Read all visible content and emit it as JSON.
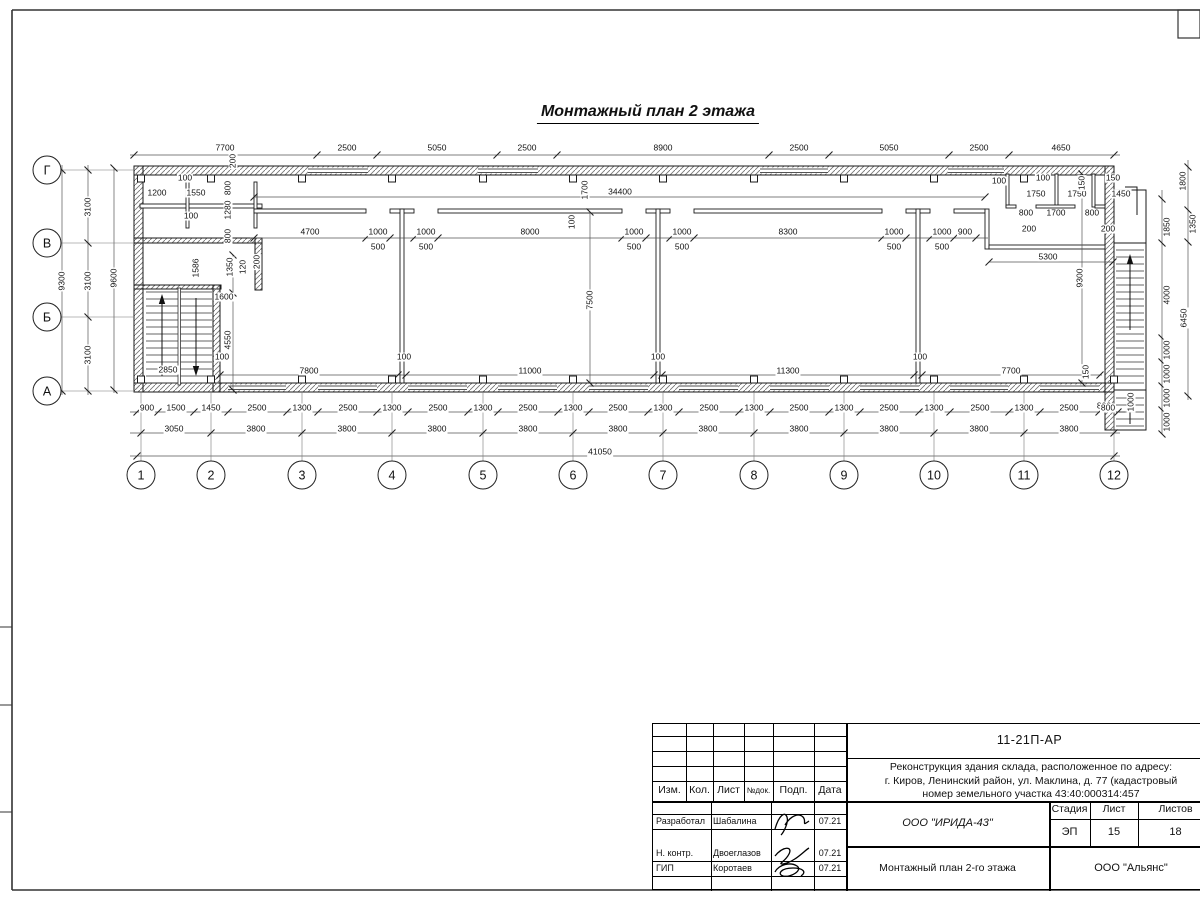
{
  "page": {
    "title_label": "Монтажный план 2 этажа"
  },
  "axes": {
    "cols": [
      {
        "label": "1",
        "x": 141
      },
      {
        "label": "2",
        "x": 211
      },
      {
        "label": "3",
        "x": 302
      },
      {
        "label": "4",
        "x": 392
      },
      {
        "label": "5",
        "x": 483
      },
      {
        "label": "6",
        "x": 573
      },
      {
        "label": "7",
        "x": 663
      },
      {
        "label": "8",
        "x": 754
      },
      {
        "label": "9",
        "x": 844
      },
      {
        "label": "10",
        "x": 934
      },
      {
        "label": "11",
        "x": 1024
      },
      {
        "label": "12",
        "x": 1114
      }
    ],
    "rows": [
      {
        "label": "Г",
        "y": 170
      },
      {
        "label": "В",
        "y": 243
      },
      {
        "label": "Б",
        "y": 317
      },
      {
        "label": "А",
        "y": 391
      }
    ]
  },
  "dims": [
    {
      "x": 225,
      "y": 148,
      "t": "7700"
    },
    {
      "x": 347,
      "y": 148,
      "t": "2500"
    },
    {
      "x": 437,
      "y": 148,
      "t": "5050"
    },
    {
      "x": 527,
      "y": 148,
      "t": "2500"
    },
    {
      "x": 663,
      "y": 148,
      "t": "8900"
    },
    {
      "x": 799,
      "y": 148,
      "t": "2500"
    },
    {
      "x": 889,
      "y": 148,
      "t": "5050"
    },
    {
      "x": 979,
      "y": 148,
      "t": "2500"
    },
    {
      "x": 1061,
      "y": 148,
      "t": "4650"
    },
    {
      "x": 233,
      "y": 161,
      "t": "200",
      "v": 1
    },
    {
      "x": 185,
      "y": 178,
      "t": "100"
    },
    {
      "x": 157,
      "y": 193,
      "t": "1200"
    },
    {
      "x": 196,
      "y": 193,
      "t": "1550"
    },
    {
      "x": 191,
      "y": 216,
      "t": "100"
    },
    {
      "x": 228,
      "y": 188,
      "t": "800",
      "v": 1
    },
    {
      "x": 228,
      "y": 210,
      "t": "1280",
      "v": 1
    },
    {
      "x": 228,
      "y": 236,
      "t": "800",
      "v": 1
    },
    {
      "x": 230,
      "y": 267,
      "t": "1350",
      "v": 1
    },
    {
      "x": 243,
      "y": 267,
      "t": "120",
      "v": 1
    },
    {
      "x": 257,
      "y": 262,
      "t": "200",
      "v": 1
    },
    {
      "x": 196,
      "y": 268,
      "t": "1586",
      "v": 1
    },
    {
      "x": 224,
      "y": 297,
      "t": "1600"
    },
    {
      "x": 228,
      "y": 340,
      "t": "4550",
      "v": 1
    },
    {
      "x": 222,
      "y": 357,
      "t": "100"
    },
    {
      "x": 168,
      "y": 370,
      "t": "2850"
    },
    {
      "x": 88,
      "y": 207,
      "t": "3100",
      "v": 1
    },
    {
      "x": 88,
      "y": 281,
      "t": "3100",
      "v": 1
    },
    {
      "x": 88,
      "y": 355,
      "t": "3100",
      "v": 1
    },
    {
      "x": 62,
      "y": 281,
      "t": "9300",
      "v": 1
    },
    {
      "x": 114,
      "y": 278,
      "t": "9600",
      "v": 1
    },
    {
      "x": 310,
      "y": 232,
      "t": "4700"
    },
    {
      "x": 378,
      "y": 232,
      "t": "1000"
    },
    {
      "x": 378,
      "y": 247,
      "t": "500"
    },
    {
      "x": 426,
      "y": 232,
      "t": "1000"
    },
    {
      "x": 426,
      "y": 247,
      "t": "500"
    },
    {
      "x": 530,
      "y": 232,
      "t": "8000"
    },
    {
      "x": 572,
      "y": 222,
      "t": "100",
      "v": 1
    },
    {
      "x": 634,
      "y": 232,
      "t": "1000"
    },
    {
      "x": 634,
      "y": 247,
      "t": "500"
    },
    {
      "x": 682,
      "y": 232,
      "t": "1000"
    },
    {
      "x": 682,
      "y": 247,
      "t": "500"
    },
    {
      "x": 788,
      "y": 232,
      "t": "8300"
    },
    {
      "x": 894,
      "y": 232,
      "t": "1000"
    },
    {
      "x": 894,
      "y": 247,
      "t": "500"
    },
    {
      "x": 942,
      "y": 232,
      "t": "1000"
    },
    {
      "x": 942,
      "y": 247,
      "t": "500"
    },
    {
      "x": 965,
      "y": 232,
      "t": "900"
    },
    {
      "x": 585,
      "y": 190,
      "t": "1700",
      "v": 1
    },
    {
      "x": 620,
      "y": 192,
      "t": "34400"
    },
    {
      "x": 590,
      "y": 300,
      "t": "7500",
      "v": 1
    },
    {
      "x": 1048,
      "y": 257,
      "t": "5300"
    },
    {
      "x": 1080,
      "y": 278,
      "t": "9300",
      "v": 1
    },
    {
      "x": 309,
      "y": 371,
      "t": "7800"
    },
    {
      "x": 404,
      "y": 357,
      "t": "100"
    },
    {
      "x": 530,
      "y": 371,
      "t": "11000"
    },
    {
      "x": 658,
      "y": 357,
      "t": "100"
    },
    {
      "x": 788,
      "y": 371,
      "t": "11300"
    },
    {
      "x": 920,
      "y": 357,
      "t": "100"
    },
    {
      "x": 1011,
      "y": 371,
      "t": "7700"
    },
    {
      "x": 1086,
      "y": 372,
      "t": "150",
      "v": 1
    },
    {
      "x": 999,
      "y": 181,
      "t": "100"
    },
    {
      "x": 1043,
      "y": 178,
      "t": "100"
    },
    {
      "x": 1036,
      "y": 194,
      "t": "1750"
    },
    {
      "x": 1077,
      "y": 194,
      "t": "1750"
    },
    {
      "x": 1082,
      "y": 183,
      "t": "150",
      "v": 1
    },
    {
      "x": 1113,
      "y": 178,
      "t": "150"
    },
    {
      "x": 1121,
      "y": 194,
      "t": "1450"
    },
    {
      "x": 1026,
      "y": 213,
      "t": "800"
    },
    {
      "x": 1056,
      "y": 213,
      "t": "1700"
    },
    {
      "x": 1092,
      "y": 213,
      "t": "800"
    },
    {
      "x": 1029,
      "y": 229,
      "t": "200"
    },
    {
      "x": 1108,
      "y": 229,
      "t": "200"
    },
    {
      "x": 1183,
      "y": 181,
      "t": "1800",
      "v": 1
    },
    {
      "x": 1193,
      "y": 224,
      "t": "1350",
      "v": 1
    },
    {
      "x": 1167,
      "y": 227,
      "t": "1850",
      "v": 1
    },
    {
      "x": 1167,
      "y": 295,
      "t": "4000",
      "v": 1
    },
    {
      "x": 1184,
      "y": 318,
      "t": "6450",
      "v": 1
    },
    {
      "x": 1167,
      "y": 350,
      "t": "1000",
      "v": 1
    },
    {
      "x": 1167,
      "y": 374,
      "t": "1000",
      "v": 1
    },
    {
      "x": 1167,
      "y": 398,
      "t": "1000",
      "v": 1
    },
    {
      "x": 1167,
      "y": 422,
      "t": "1000",
      "v": 1
    },
    {
      "x": 1104,
      "y": 406,
      "t": "800"
    },
    {
      "x": 1131,
      "y": 402,
      "t": "1000",
      "v": 1
    },
    {
      "x": 147,
      "y": 408,
      "t": "900"
    },
    {
      "x": 176,
      "y": 408,
      "t": "1500"
    },
    {
      "x": 211,
      "y": 408,
      "t": "1450"
    },
    {
      "x": 257,
      "y": 408,
      "t": "2500"
    },
    {
      "x": 302,
      "y": 408,
      "t": "1300"
    },
    {
      "x": 348,
      "y": 408,
      "t": "2500"
    },
    {
      "x": 392,
      "y": 408,
      "t": "1300"
    },
    {
      "x": 438,
      "y": 408,
      "t": "2500"
    },
    {
      "x": 483,
      "y": 408,
      "t": "1300"
    },
    {
      "x": 528,
      "y": 408,
      "t": "2500"
    },
    {
      "x": 573,
      "y": 408,
      "t": "1300"
    },
    {
      "x": 618,
      "y": 408,
      "t": "2500"
    },
    {
      "x": 663,
      "y": 408,
      "t": "1300"
    },
    {
      "x": 709,
      "y": 408,
      "t": "2500"
    },
    {
      "x": 754,
      "y": 408,
      "t": "1300"
    },
    {
      "x": 799,
      "y": 408,
      "t": "2500"
    },
    {
      "x": 844,
      "y": 408,
      "t": "1300"
    },
    {
      "x": 889,
      "y": 408,
      "t": "2500"
    },
    {
      "x": 934,
      "y": 408,
      "t": "1300"
    },
    {
      "x": 980,
      "y": 408,
      "t": "2500"
    },
    {
      "x": 1024,
      "y": 408,
      "t": "1300"
    },
    {
      "x": 1069,
      "y": 408,
      "t": "2500"
    },
    {
      "x": 1108,
      "y": 408,
      "t": "800"
    },
    {
      "x": 174,
      "y": 429,
      "t": "3050"
    },
    {
      "x": 256,
      "y": 429,
      "t": "3800"
    },
    {
      "x": 347,
      "y": 429,
      "t": "3800"
    },
    {
      "x": 437,
      "y": 429,
      "t": "3800"
    },
    {
      "x": 528,
      "y": 429,
      "t": "3800"
    },
    {
      "x": 618,
      "y": 429,
      "t": "3800"
    },
    {
      "x": 708,
      "y": 429,
      "t": "3800"
    },
    {
      "x": 799,
      "y": 429,
      "t": "3800"
    },
    {
      "x": 889,
      "y": 429,
      "t": "3800"
    },
    {
      "x": 979,
      "y": 429,
      "t": "3800"
    },
    {
      "x": 1069,
      "y": 429,
      "t": "3800"
    },
    {
      "x": 600,
      "y": 452,
      "t": "41050"
    }
  ],
  "title_block": {
    "doc_number": "11-21П-АР",
    "project_lines": [
      "Реконструкция здания склада, расположенное по адресу:",
      "г. Киров, Ленинский район, ул. Маклина, д. 77 (кадастровый",
      "номер земельного участка 43:40:000314:457"
    ],
    "header_cells": [
      "Изм.",
      "Кол.",
      "Лист",
      "№док.",
      "Подп.",
      "Дата"
    ],
    "sign_rows": [
      {
        "role": "Разработал",
        "name": "Шабалина",
        "date": "07.21"
      },
      {
        "role": "Н. контр.",
        "name": "Двоеглазов",
        "date": "07.21"
      },
      {
        "role": "ГИП",
        "name": "Коротаев",
        "date": "07.21"
      }
    ],
    "org": "ООО \"ИРИДА-43\"",
    "sheet_title": "Монтажный план 2-го этажа",
    "stage_label": "Стадия",
    "list_label": "Лист",
    "lists_label": "Листов",
    "stage": "ЭП",
    "list_no": "15",
    "lists_total": "18",
    "company": "ООО \"Альянс\""
  }
}
